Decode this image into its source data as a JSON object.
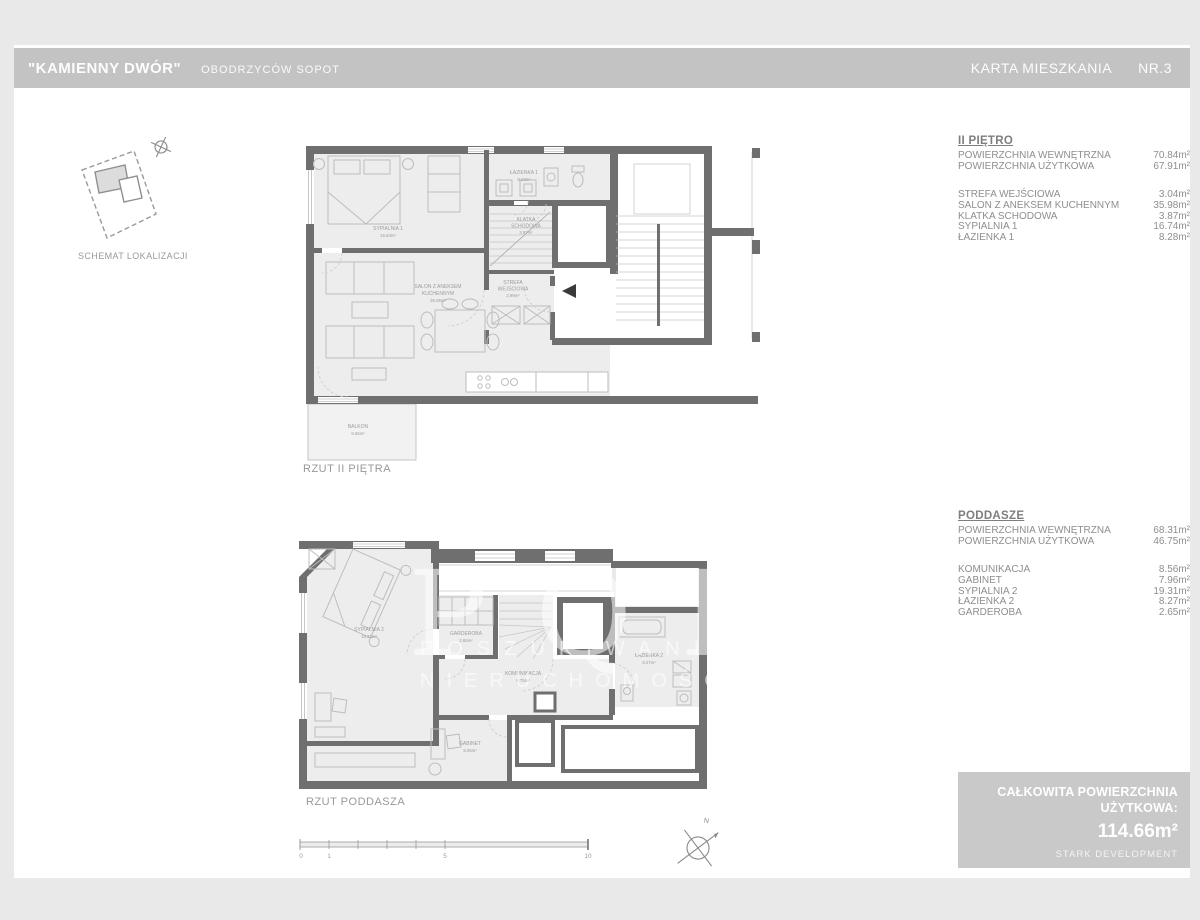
{
  "header": {
    "project_name": "\"KAMIENNY DWÓR\"",
    "project_location": "OBODRZYCÓW SOPOT",
    "card_title": "KARTA MIESZKANIA",
    "card_number": "NR.3"
  },
  "location_schematic": {
    "caption": "SCHEMAT LOKALIZACJI"
  },
  "floor_upper": {
    "title": "II PIĘTRO",
    "summary": [
      {
        "label": "POWIERZCHNIA WEWNĘTRZNA",
        "value": "70.84m²"
      },
      {
        "label": "POWIERZCHNIA UŻYTKOWA",
        "value": "67.91m²"
      }
    ],
    "rooms": [
      {
        "label": "STREFA WEJŚCIOWA",
        "value": "3.04m²"
      },
      {
        "label": "SALON Z ANEKSEM KUCHENNYM",
        "value": "35.98m²"
      },
      {
        "label": "KLATKA SCHODOWA",
        "value": "3.87m²"
      },
      {
        "label": "SYPIALNIA 1",
        "value": "16.74m²"
      },
      {
        "label": "ŁAZIENKA 1",
        "value": "8.28m²"
      }
    ],
    "plan_caption": "RZUT II PIĘTRA",
    "plan_labels": {
      "sypialnia": {
        "name": "SYPIALNIA 1",
        "area": "16.84m²"
      },
      "lazienka": {
        "name": "ŁAZIENKA 1",
        "area": "8.23m²"
      },
      "klatka": {
        "name": "KLATKA",
        "name2": "SCHODOWA",
        "area": "3.87m²"
      },
      "salon": {
        "name": "SALON Z ANEKSEM",
        "name2": "KUCHENNYM",
        "area": "36.05m²"
      },
      "strefa": {
        "name": "STREFA",
        "name2": "WEJŚCIOWA",
        "area": "2.99m²"
      },
      "balkon": {
        "name": "BALKON",
        "area": "6.66m²"
      }
    }
  },
  "floor_attic": {
    "title": "PODDASZE",
    "summary": [
      {
        "label": "POWIERZCHNIA WEWNĘTRZNA",
        "value": "68.31m²"
      },
      {
        "label": "POWIERZCHNIA UŻYTKOWA",
        "value": "46.75m²"
      }
    ],
    "rooms": [
      {
        "label": "KOMUNIKACJA",
        "value": "8.56m²"
      },
      {
        "label": "GABINET",
        "value": "7.96m²"
      },
      {
        "label": "SYPIALNIA 2",
        "value": "19.31m²"
      },
      {
        "label": "ŁAZIENKA 2",
        "value": "8.27m²"
      },
      {
        "label": "GARDEROBA",
        "value": "2.65m²"
      }
    ],
    "plan_caption": "RZUT PODDASZA",
    "plan_labels": {
      "sypialnia": {
        "name": "SYPIALNIA 2",
        "area": "19.31m²"
      },
      "garderoba": {
        "name": "GARDEROBA",
        "area": "2.65m²"
      },
      "komunikacja": {
        "name": "KOMUNIKACJA",
        "area": "8.75m²"
      },
      "lazienka": {
        "name": "ŁAZIENKA 2",
        "area": "8.27m²"
      },
      "gabinet": {
        "name": "GABINET",
        "area": "8.05m²"
      }
    }
  },
  "total_box": {
    "line1": "CAŁKOWITA POWIERZCHNIA",
    "line2": "UŻYTKOWA:",
    "value": "114.66m²",
    "brand": "STARK DEVELOPMENT"
  },
  "watermark": {
    "big": "PQR",
    "line2": "POSZUKIWANIA",
    "line3": "NIERUCHOMOŚCI"
  },
  "scale_bar": {
    "ticks": [
      "0",
      "1",
      "5",
      "10"
    ]
  },
  "compass": {
    "north_label": "N"
  }
}
